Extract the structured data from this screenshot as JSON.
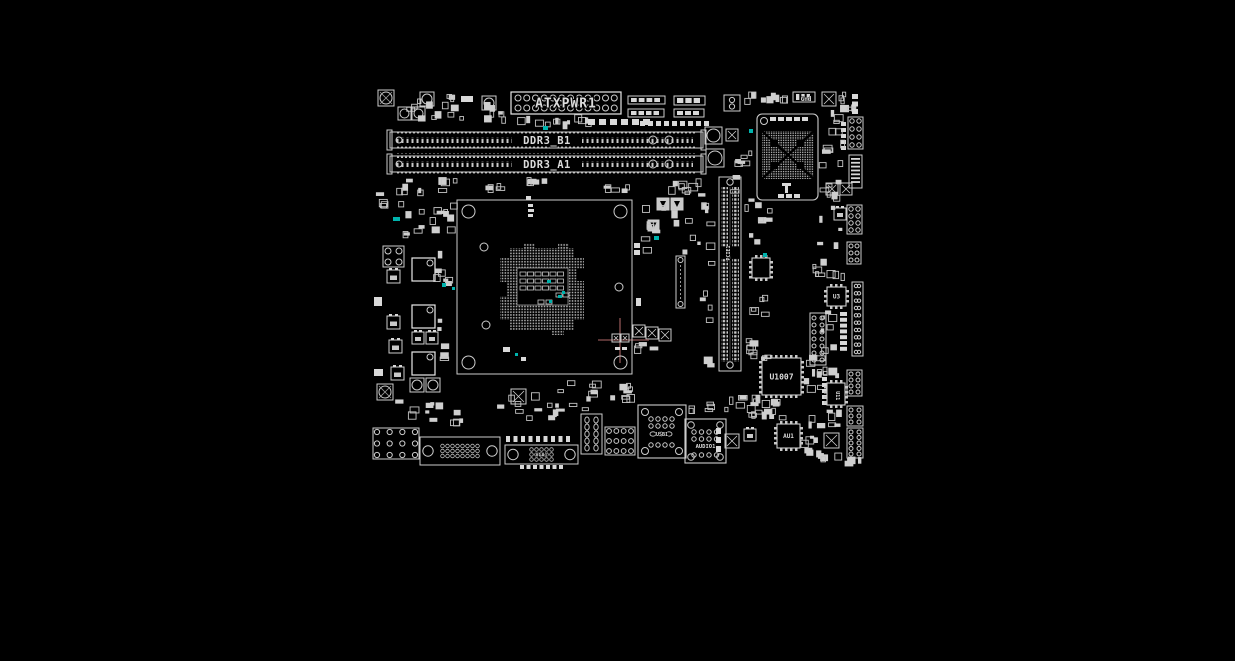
{
  "meta": {
    "title": "Motherboard PCB component placement view",
    "canvas_w": 1235,
    "canvas_h": 661
  },
  "colors": {
    "background": "#000000",
    "silk": "#cdcdcd",
    "silk_bright": "#e8e8e8",
    "pad": "#d9d9d9",
    "dim": "#999999",
    "teal": "#00b3ad",
    "crosshair": "#754545",
    "text": "#dcdcdc"
  },
  "components": [
    {
      "t": "screw",
      "n": "mounting-hole",
      "x": 378,
      "y": 90,
      "s": 16
    },
    {
      "t": "cluster",
      "n": "smd-cluster",
      "x": 395,
      "y": 92,
      "w": 72,
      "h": 34,
      "c": 14,
      "seed": 1
    },
    {
      "t": "cap",
      "n": "capacitor",
      "x": 398,
      "y": 107,
      "s": 13
    },
    {
      "t": "cap",
      "n": "capacitor",
      "x": 412,
      "y": 107,
      "s": 13
    },
    {
      "t": "cap",
      "n": "capacitor",
      "x": 420,
      "y": 92,
      "s": 14
    },
    {
      "t": "rf",
      "n": "pad",
      "x": 461,
      "y": 96,
      "w": 12,
      "h": 6
    },
    {
      "t": "cap",
      "n": "capacitor",
      "x": 482,
      "y": 96,
      "s": 14
    },
    {
      "t": "cluster",
      "n": "smd-cluster",
      "x": 477,
      "y": 100,
      "w": 34,
      "h": 26,
      "c": 8,
      "seed": 2
    },
    {
      "t": "atx",
      "n": "atx-power-connector",
      "x": 511,
      "y": 92,
      "w": 110,
      "h": 22,
      "label": "ATXPWR1"
    },
    {
      "t": "cluster",
      "n": "smd-cluster",
      "x": 512,
      "y": 114,
      "w": 80,
      "h": 16,
      "c": 12,
      "seed": 3
    },
    {
      "t": "teal",
      "n": "highlight",
      "x": 543,
      "y": 126,
      "w": 5,
      "h": 4
    },
    {
      "t": "padrow",
      "n": "pad-row",
      "x": 588,
      "y": 119,
      "c": 6,
      "pw": 7,
      "ph": 6,
      "g": 4
    },
    {
      "t": "padrow",
      "n": "pad-row",
      "x": 640,
      "y": 121,
      "c": 9,
      "pw": 5,
      "ph": 5,
      "g": 3
    },
    {
      "t": "bar",
      "n": "connector-footprint",
      "x": 628,
      "y": 96,
      "w": 37,
      "h": 8
    },
    {
      "t": "bar",
      "n": "connector-footprint",
      "x": 628,
      "y": 109,
      "w": 36,
      "h": 8
    },
    {
      "t": "bar",
      "n": "connector-footprint",
      "x": 674,
      "y": 96,
      "w": 31,
      "h": 9
    },
    {
      "t": "bar",
      "n": "connector-footprint",
      "x": 674,
      "y": 109,
      "w": 30,
      "h": 8
    },
    {
      "t": "xtal",
      "n": "crystal",
      "x": 724,
      "y": 95,
      "s": 16
    },
    {
      "t": "cluster",
      "n": "smd-cluster",
      "x": 744,
      "y": 90,
      "w": 48,
      "h": 16,
      "c": 9,
      "seed": 4
    },
    {
      "t": "bar",
      "n": "connector-footprint",
      "x": 793,
      "y": 92,
      "w": 22,
      "h": 10
    },
    {
      "t": "text",
      "n": "silk-label",
      "x": 806,
      "y": 101,
      "size": 6,
      "label": "Gnd"
    },
    {
      "t": "xcap",
      "n": "capacitor",
      "x": 822,
      "y": 92,
      "s": 14
    },
    {
      "t": "cluster",
      "n": "smd-cluster",
      "x": 838,
      "y": 92,
      "w": 28,
      "h": 24,
      "c": 6,
      "seed": 5
    },
    {
      "t": "padcol",
      "n": "pad-column",
      "x": 852,
      "y": 94,
      "c": 3,
      "pw": 6,
      "ph": 5,
      "g": 2.5
    },
    {
      "t": "cap",
      "n": "buzzer",
      "x": 705,
      "y": 127,
      "s": 17
    },
    {
      "t": "cap",
      "n": "buzzer",
      "x": 706,
      "y": 149,
      "s": 18
    },
    {
      "t": "xcap",
      "n": "capacitor",
      "x": 726,
      "y": 129,
      "s": 12
    },
    {
      "t": "dimm",
      "n": "dimm-slot-b1",
      "x": 390,
      "y": 129,
      "w": 313,
      "h": 22,
      "label": "DDR3_B1"
    },
    {
      "t": "dimm",
      "n": "dimm-slot-a1",
      "x": 390,
      "y": 153,
      "w": 313,
      "h": 22,
      "label": "DDR3_A1"
    },
    {
      "t": "cluster",
      "n": "smd-cluster",
      "x": 390,
      "y": 177,
      "w": 70,
      "h": 19,
      "c": 10,
      "seed": 8
    },
    {
      "t": "cluster",
      "n": "smd-cluster",
      "x": 514,
      "y": 177,
      "w": 42,
      "h": 14,
      "c": 5,
      "seed": 9
    },
    {
      "t": "cluster",
      "n": "smd-cluster",
      "x": 596,
      "y": 178,
      "w": 40,
      "h": 16,
      "c": 5,
      "seed": 41
    },
    {
      "t": "cluster",
      "n": "smd-cluster",
      "x": 660,
      "y": 177,
      "w": 45,
      "h": 18,
      "c": 8,
      "seed": 7
    },
    {
      "t": "cluster",
      "n": "smd-cluster",
      "x": 462,
      "y": 182,
      "w": 44,
      "h": 13,
      "c": 4,
      "seed": 40
    },
    {
      "t": "bga",
      "n": "chipset",
      "x": 757,
      "y": 114,
      "w": 61,
      "h": 86
    },
    {
      "t": "cluster",
      "n": "smd-cluster",
      "x": 730,
      "y": 148,
      "w": 24,
      "h": 55,
      "c": 8,
      "seed": 11
    },
    {
      "t": "teal",
      "n": "highlight",
      "x": 749,
      "y": 129,
      "w": 4,
      "h": 4
    },
    {
      "t": "pcie",
      "n": "pcie-x16-slot",
      "x": 719,
      "y": 177,
      "w": 22,
      "h": 194,
      "label": "PCIE1"
    },
    {
      "t": "cluster",
      "n": "smd-cluster",
      "x": 697,
      "y": 183,
      "w": 18,
      "h": 185,
      "c": 14,
      "seed": 12
    },
    {
      "t": "cluster",
      "n": "smd-cluster",
      "x": 744,
      "y": 196,
      "w": 30,
      "h": 58,
      "c": 9,
      "seed": 13
    },
    {
      "t": "ic",
      "n": "ic",
      "x": 752,
      "y": 258,
      "w": 18,
      "h": 20,
      "label": "",
      "fs": 5
    },
    {
      "t": "teal",
      "n": "highlight",
      "x": 763,
      "y": 253,
      "w": 4,
      "h": 4
    },
    {
      "t": "cluster",
      "n": "smd-cluster",
      "x": 744,
      "y": 282,
      "w": 26,
      "h": 38,
      "c": 5,
      "seed": 43
    },
    {
      "t": "cluster",
      "n": "smd-cluster",
      "x": 745,
      "y": 325,
      "w": 28,
      "h": 40,
      "c": 6,
      "seed": 44
    },
    {
      "t": "diode",
      "n": "diode",
      "x": 657,
      "y": 198,
      "s": 12
    },
    {
      "t": "diode",
      "n": "diode",
      "x": 671,
      "y": 198,
      "s": 12
    },
    {
      "t": "diode",
      "n": "diode",
      "x": 648,
      "y": 220,
      "s": 11
    },
    {
      "t": "cluster",
      "n": "smd-cluster",
      "x": 640,
      "y": 200,
      "w": 58,
      "h": 55,
      "c": 12,
      "seed": 14
    },
    {
      "t": "teal",
      "n": "highlight",
      "x": 654,
      "y": 236,
      "w": 5,
      "h": 4
    },
    {
      "t": "slotv",
      "n": "vertical-connector",
      "x": 676,
      "y": 256,
      "w": 9,
      "h": 52
    },
    {
      "t": "xcap",
      "n": "capacitor",
      "x": 633,
      "y": 325,
      "s": 12
    },
    {
      "t": "xcap",
      "n": "capacitor",
      "x": 646,
      "y": 327,
      "s": 12
    },
    {
      "t": "xcap",
      "n": "capacitor",
      "x": 659,
      "y": 329,
      "s": 12
    },
    {
      "t": "cluster",
      "n": "smd-cluster",
      "x": 632,
      "y": 342,
      "w": 34,
      "h": 12,
      "c": 4,
      "seed": 15
    },
    {
      "t": "crosshair",
      "n": "cursor-crosshair",
      "x": 620,
      "y": 340,
      "hx1": 598,
      "hx2": 649,
      "vy1": 318,
      "vy2": 363
    },
    {
      "t": "xcap",
      "n": "capacitor",
      "x": 612,
      "y": 334,
      "s": 8
    },
    {
      "t": "xcap",
      "n": "capacitor",
      "x": 621,
      "y": 334,
      "s": 8
    },
    {
      "t": "padrow",
      "n": "pad-row",
      "x": 615,
      "y": 347,
      "c": 2,
      "pw": 5,
      "ph": 3,
      "g": 2
    },
    {
      "t": "socket",
      "n": "cpu-socket",
      "x": 457,
      "y": 200,
      "w": 175,
      "h": 174
    },
    {
      "t": "rf",
      "n": "pad",
      "x": 634,
      "y": 243,
      "w": 6,
      "h": 5
    },
    {
      "t": "rf",
      "n": "pad",
      "x": 634,
      "y": 250,
      "w": 6,
      "h": 5
    },
    {
      "t": "rf",
      "n": "pad",
      "x": 636,
      "y": 298,
      "w": 5,
      "h": 8
    },
    {
      "t": "sq4",
      "n": "pad-array",
      "x": 383,
      "y": 246,
      "s": 21
    },
    {
      "t": "choke",
      "n": "vrm-choke",
      "x": 412,
      "y": 258,
      "s": 23
    },
    {
      "t": "choke",
      "n": "vrm-choke",
      "x": 412,
      "y": 305,
      "s": 23
    },
    {
      "t": "choke",
      "n": "vrm-choke",
      "x": 412,
      "y": 352,
      "s": 23
    },
    {
      "t": "mos",
      "n": "mosfet",
      "x": 387,
      "y": 270,
      "s": 13
    },
    {
      "t": "mos",
      "n": "mosfet",
      "x": 387,
      "y": 316,
      "s": 13
    },
    {
      "t": "mos",
      "n": "mosfet",
      "x": 389,
      "y": 340,
      "s": 13
    },
    {
      "t": "mos",
      "n": "mosfet",
      "x": 391,
      "y": 367,
      "s": 13
    },
    {
      "t": "mos",
      "n": "mosfet",
      "x": 412,
      "y": 332,
      "s": 12
    },
    {
      "t": "mos",
      "n": "mosfet",
      "x": 426,
      "y": 332,
      "s": 12
    },
    {
      "t": "cap",
      "n": "capacitor",
      "x": 410,
      "y": 378,
      "s": 14
    },
    {
      "t": "cap",
      "n": "capacitor",
      "x": 426,
      "y": 378,
      "s": 14
    },
    {
      "t": "cluster",
      "n": "smd-cluster",
      "x": 433,
      "y": 240,
      "w": 23,
      "h": 128,
      "c": 12,
      "seed": 16
    },
    {
      "t": "teal",
      "n": "highlight",
      "x": 442,
      "y": 283,
      "w": 4,
      "h": 4
    },
    {
      "t": "teal",
      "n": "highlight",
      "x": 452,
      "y": 287,
      "w": 3,
      "h": 3
    },
    {
      "t": "cluster",
      "n": "smd-cluster",
      "x": 374,
      "y": 188,
      "w": 14,
      "h": 26,
      "c": 4,
      "seed": 17
    },
    {
      "t": "rf",
      "n": "pad",
      "x": 374,
      "y": 297,
      "w": 8,
      "h": 9
    },
    {
      "t": "rf",
      "n": "pad",
      "x": 374,
      "y": 369,
      "w": 9,
      "h": 7
    },
    {
      "t": "cluster",
      "n": "smd-cluster",
      "x": 391,
      "y": 199,
      "w": 70,
      "h": 42,
      "c": 16,
      "seed": 18
    },
    {
      "t": "teal",
      "n": "highlight",
      "x": 393,
      "y": 217,
      "w": 7,
      "h": 4
    },
    {
      "t": "screw",
      "n": "mounting-hole",
      "x": 377,
      "y": 384,
      "s": 16
    },
    {
      "t": "cluster",
      "n": "smd-cluster",
      "x": 392,
      "y": 398,
      "w": 76,
      "h": 28,
      "c": 12,
      "seed": 19
    },
    {
      "t": "boxhdr",
      "n": "io-header",
      "x": 373,
      "y": 428,
      "w": 46,
      "h": 31,
      "cols": 4,
      "rows": 3,
      "r": 2.6
    },
    {
      "t": "dsub",
      "n": "dsub-connector",
      "x": 420,
      "y": 437,
      "w": 80,
      "h": 28,
      "cols": 8,
      "rows": 3,
      "r": 1.8,
      "label": ""
    },
    {
      "t": "dsub",
      "n": "vga-connector",
      "x": 505,
      "y": 445,
      "w": 73,
      "h": 19,
      "cols": 5,
      "rows": 3,
      "r": 1.8,
      "label": "VGA1"
    },
    {
      "t": "padrow",
      "n": "pad-row",
      "x": 506,
      "y": 436,
      "c": 9,
      "pw": 4,
      "ph": 6,
      "g": 3.5
    },
    {
      "t": "padrow",
      "n": "pad-row",
      "x": 520,
      "y": 465,
      "c": 7,
      "pw": 4,
      "ph": 4,
      "g": 2.5
    },
    {
      "t": "cluster",
      "n": "smd-cluster",
      "x": 495,
      "y": 388,
      "w": 70,
      "h": 34,
      "c": 14,
      "seed": 20
    },
    {
      "t": "xcap",
      "n": "capacitor",
      "x": 511,
      "y": 389,
      "s": 15
    },
    {
      "t": "cluster",
      "n": "smd-cluster",
      "x": 566,
      "y": 380,
      "w": 38,
      "h": 32,
      "c": 8,
      "seed": 21
    },
    {
      "t": "cluster",
      "n": "smd-cluster",
      "x": 608,
      "y": 383,
      "w": 28,
      "h": 14,
      "c": 4,
      "seed": 42
    },
    {
      "t": "ovconn",
      "n": "display-connector",
      "x": 581,
      "y": 414,
      "w": 21,
      "h": 40
    },
    {
      "t": "boxhdr",
      "n": "io-header",
      "x": 605,
      "y": 427,
      "w": 30,
      "h": 28,
      "cols": 4,
      "rows": 3,
      "r": 2.4
    },
    {
      "t": "cluster",
      "n": "smd-cluster",
      "x": 606,
      "y": 394,
      "w": 30,
      "h": 12,
      "c": 4,
      "seed": 23
    },
    {
      "t": "usb",
      "n": "usb-lan-stack",
      "x": 638,
      "y": 405,
      "w": 48,
      "h": 53,
      "label": "USB1"
    },
    {
      "t": "audio",
      "n": "audio-connector",
      "x": 685,
      "y": 419,
      "w": 41,
      "h": 44,
      "label": "AUDIO1"
    },
    {
      "t": "cluster",
      "n": "smd-cluster",
      "x": 688,
      "y": 402,
      "w": 34,
      "h": 14,
      "c": 5,
      "seed": 24
    },
    {
      "t": "padcol",
      "n": "pad-column",
      "x": 716,
      "y": 428,
      "c": 3,
      "pw": 5,
      "ph": 6,
      "g": 3
    },
    {
      "t": "cluster",
      "n": "smd-cluster",
      "x": 722,
      "y": 395,
      "w": 58,
      "h": 28,
      "c": 12,
      "seed": 25
    },
    {
      "t": "ic",
      "n": "audio-codec",
      "x": 777,
      "y": 424,
      "w": 23,
      "h": 24,
      "label": "AU1",
      "fs": 6
    },
    {
      "t": "xcap",
      "n": "capacitor",
      "x": 725,
      "y": 434,
      "s": 14
    },
    {
      "t": "xcap",
      "n": "capacitor",
      "x": 824,
      "y": 433,
      "s": 15
    },
    {
      "t": "cluster",
      "n": "smd-cluster",
      "x": 797,
      "y": 428,
      "w": 24,
      "h": 28,
      "c": 6,
      "seed": 26
    },
    {
      "t": "boxhdr",
      "n": "pin-header",
      "x": 847,
      "y": 406,
      "w": 16,
      "h": 20,
      "cols": 2,
      "rows": 3,
      "r": 2
    },
    {
      "t": "boxhdr",
      "n": "pin-header",
      "x": 847,
      "y": 428,
      "w": 16,
      "h": 30,
      "cols": 2,
      "rows": 5,
      "r": 2
    },
    {
      "t": "cluster",
      "n": "smd-cluster",
      "x": 805,
      "y": 450,
      "w": 38,
      "h": 12,
      "c": 5,
      "seed": 27
    },
    {
      "t": "mos",
      "n": "mosfet",
      "x": 744,
      "y": 429,
      "s": 12
    },
    {
      "t": "ic",
      "n": "super-io",
      "x": 762,
      "y": 358,
      "w": 39,
      "h": 37,
      "label": "U1007",
      "fs": 8
    },
    {
      "t": "cluster",
      "n": "smd-cluster",
      "x": 745,
      "y": 398,
      "w": 55,
      "h": 22,
      "c": 12,
      "seed": 29
    },
    {
      "t": "cluster",
      "n": "smd-cluster",
      "x": 802,
      "y": 352,
      "w": 28,
      "h": 42,
      "c": 8,
      "seed": 30
    },
    {
      "t": "cluster",
      "n": "smd-cluster",
      "x": 745,
      "y": 340,
      "w": 15,
      "h": 15,
      "c": 3,
      "seed": 31
    },
    {
      "t": "padcol",
      "n": "pad-column",
      "x": 822,
      "y": 377,
      "c": 5,
      "pw": 5,
      "ph": 4,
      "g": 2
    },
    {
      "t": "boxhdr",
      "n": "pin-header",
      "x": 848,
      "y": 117,
      "w": 15,
      "h": 32,
      "cols": 2,
      "rows": 4,
      "r": 2.2
    },
    {
      "t": "padcol",
      "n": "pad-column",
      "x": 841,
      "y": 122,
      "c": 5,
      "pw": 5,
      "ph": 4,
      "g": 2
    },
    {
      "t": "cluster",
      "n": "smd-cluster",
      "x": 820,
      "y": 105,
      "w": 25,
      "h": 52,
      "c": 9,
      "seed": 32
    },
    {
      "t": "ffc",
      "n": "ffc-connector",
      "x": 849,
      "y": 155,
      "w": 13,
      "h": 33
    },
    {
      "t": "cluster",
      "n": "smd-cluster",
      "x": 816,
      "y": 160,
      "w": 28,
      "h": 92,
      "c": 13,
      "seed": 33
    },
    {
      "t": "xcap",
      "n": "capacitor",
      "x": 826,
      "y": 183,
      "s": 12
    },
    {
      "t": "xcap",
      "n": "capacitor",
      "x": 840,
      "y": 183,
      "s": 12
    },
    {
      "t": "boxhdr",
      "n": "pin-header",
      "x": 847,
      "y": 205,
      "w": 15,
      "h": 29,
      "cols": 2,
      "rows": 4,
      "r": 2.2
    },
    {
      "t": "mos",
      "n": "mosfet",
      "x": 834,
      "y": 208,
      "s": 12
    },
    {
      "t": "boxhdr",
      "n": "pin-header",
      "x": 847,
      "y": 242,
      "w": 14,
      "h": 22,
      "cols": 2,
      "rows": 3,
      "r": 2
    },
    {
      "t": "cluster",
      "n": "smd-cluster",
      "x": 812,
      "y": 258,
      "w": 33,
      "h": 24,
      "c": 8,
      "seed": 34
    },
    {
      "t": "ic",
      "n": "ic-u3",
      "x": 827,
      "y": 287,
      "w": 19,
      "h": 19,
      "label": "U3",
      "fs": 6
    },
    {
      "t": "boxhdr",
      "n": "pin-header",
      "x": 852,
      "y": 282,
      "w": 11,
      "h": 74,
      "cols": 2,
      "rows": 10,
      "r": 1.7
    },
    {
      "t": "dip",
      "n": "dip-ic",
      "x": 810,
      "y": 313,
      "w": 16,
      "h": 52
    },
    {
      "t": "padcol",
      "n": "pad-column",
      "x": 840,
      "y": 312,
      "c": 7,
      "pw": 7,
      "ph": 4,
      "g": 1.8
    },
    {
      "t": "cluster",
      "n": "smd-cluster",
      "x": 820,
      "y": 310,
      "w": 18,
      "h": 44,
      "c": 7,
      "seed": 35
    },
    {
      "t": "boxhdr",
      "n": "pin-header",
      "x": 847,
      "y": 370,
      "w": 15,
      "h": 26,
      "cols": 2,
      "rows": 4,
      "r": 2
    },
    {
      "t": "ic",
      "n": "ic-u11",
      "x": 827,
      "y": 383,
      "w": 18,
      "h": 22,
      "label": "U11",
      "fs": 5,
      "rot": 90
    },
    {
      "t": "cluster",
      "n": "smd-cluster",
      "x": 810,
      "y": 366,
      "w": 34,
      "h": 13,
      "c": 5,
      "seed": 36
    },
    {
      "t": "cluster",
      "n": "smd-cluster",
      "x": 808,
      "y": 405,
      "w": 34,
      "h": 24,
      "c": 8,
      "seed": 37
    },
    {
      "t": "cluster",
      "n": "smd-cluster",
      "x": 840,
      "y": 455,
      "w": 22,
      "h": 12,
      "c": 4,
      "seed": 38
    }
  ]
}
